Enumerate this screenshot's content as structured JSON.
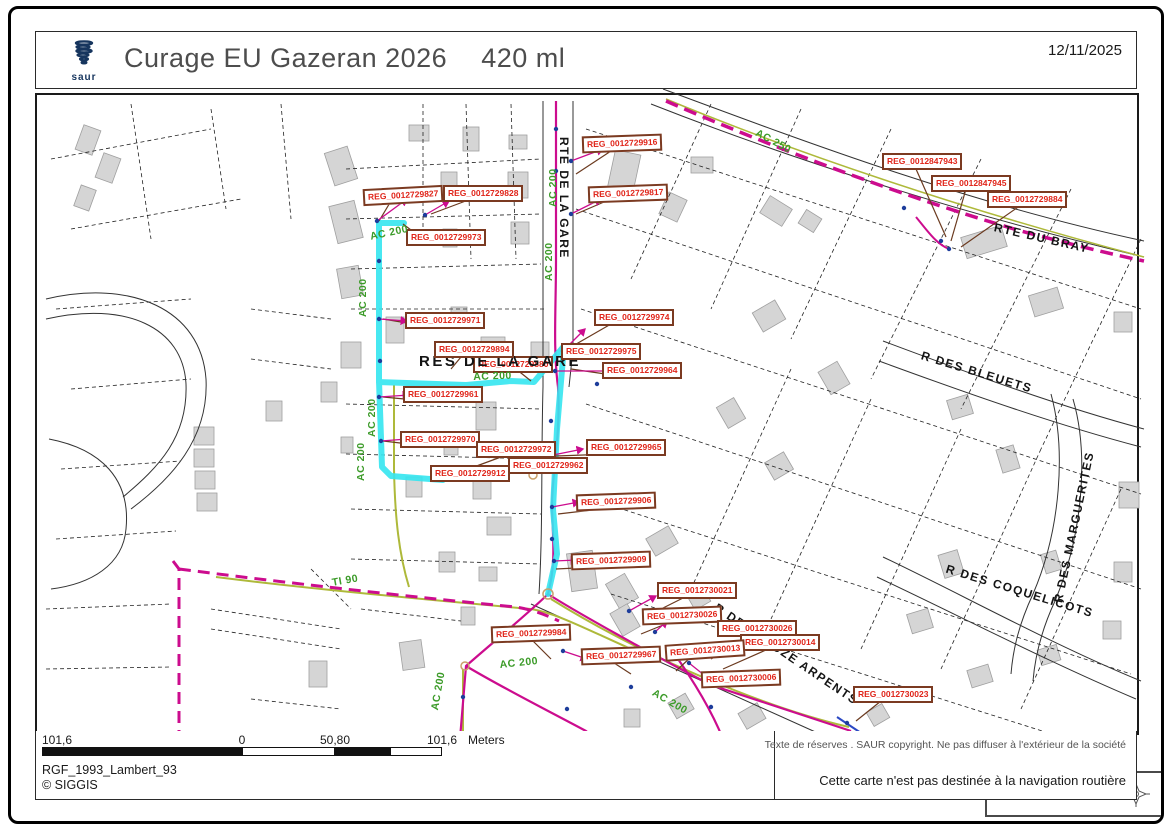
{
  "header": {
    "title_main": "Curage EU Gazeran 2026",
    "title_qty": "420 ml",
    "logo_text": "saur",
    "date": "12/11/2025"
  },
  "icons": {
    "logo": "saur-logo",
    "compass": "compass-rose"
  },
  "map": {
    "scale_label": "1:2 000",
    "reg_labels": [
      "REG_0012729827",
      "REG_0012729828",
      "REG_0012729916",
      "REG_0012729817",
      "REG_0012847943",
      "REG_0012847945",
      "REG_0012729884",
      "REG_0012729973",
      "REG_0012729971",
      "REG_0012729974",
      "REG_0012729894",
      "REG_0012729880",
      "REG_0012729975",
      "REG_0012729964",
      "REG_0012729961",
      "REG_0012729970",
      "REG_0012729972",
      "REG_0012729965",
      "REG_0012729962",
      "REG_0012729912",
      "REG_0012729906",
      "REG_0012729909",
      "REG_0012730021",
      "REG_0012730026",
      "REG_0012730026",
      "REG_0012730014",
      "REG_0012729984",
      "REG_0012729967",
      "REG_0012730013",
      "REG_0012730006",
      "REG_0012730023"
    ],
    "streets": [
      "RTE DE LA GARE",
      "RES DE LA GARE",
      "RTE DU BRAY",
      "R DES BLEUETS",
      "R DES MARGUERITES",
      "R DES COQUELICOTS",
      "R DES DOUZE ARPENTS"
    ],
    "pipe_labels": [
      "AC 200",
      "AC 200",
      "AC 200",
      "AC 200",
      "AC 200",
      "AC 200",
      "TI 90",
      "AC 200",
      "AC 200",
      "AC 200",
      "AC 250",
      "AC 200"
    ]
  },
  "footer": {
    "scalebar": {
      "labels": [
        "101,6",
        "0",
        "50,80",
        "101,6"
      ],
      "unit": "Meters"
    },
    "projection": "RGF_1993_Lambert_93",
    "copyright": "© SIGGIS",
    "reserve_text": "Texte de réserves . SAUR copyright. Ne pas diffuser à l'extérieur de la société",
    "nav_text": "Cette carte n'est pas destinée à la navigation routière"
  },
  "colors": {
    "pipe_magenta": "#cc0c8e",
    "highlight_cyan": "#35e6f0",
    "pipe_green_label": "#3c9b29",
    "reg_text_red": "#e02419",
    "reg_border_brown": "#7b3a21",
    "logo_navy": "#16355e"
  }
}
